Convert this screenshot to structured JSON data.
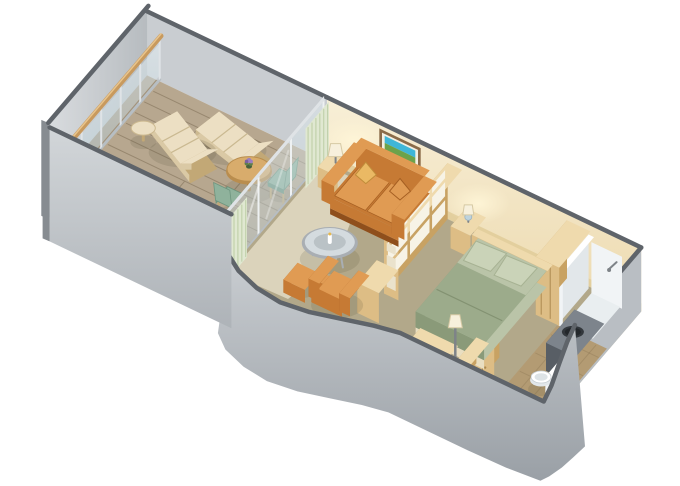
{
  "meta": {
    "title": "Veranda Stateroom Isometric Floor Plan",
    "kind": "isometric-floorplan-illustration"
  },
  "colors": {
    "bg": "#ffffff",
    "wall_edge": "#5f646a",
    "wall_cap_side": "#878c91",
    "wall_gray": "#c9cdd1",
    "wall_gray_right": "#b9bec3",
    "grad_l1": "#d9dcdf",
    "grad_l2": "#b6bbbf",
    "grad_f1": "#d2d6d9",
    "grad_f2": "#aeb3b8",
    "grad_c1": "#c9cdd1",
    "grad_c2": "#9aa0a6",
    "cream1": "#f8efd7",
    "cream2": "#ecd9ae",
    "cream_base": "#e3cf9e",
    "glow": "#fff6d8",
    "floor": "#b2a88a",
    "rug": "#dbd3bb",
    "deck": "#b7a78f",
    "deck_dark": "#a3937b",
    "deck_line": "#97876f",
    "rail_frame": "#dfe3e6",
    "rail_frame2": "#eef1f2",
    "glass1": "#e3eef2",
    "glass2": "#b7ccd5",
    "handrail": "#c89a5e",
    "handrail_hi": "#e8c48c",
    "curtain": "#e0e8d1",
    "curtain_dk": "#c2d1ac",
    "wood_top": "#efdaad",
    "wood_front": "#ddbd85",
    "wood_side": "#c8a263",
    "wood_seam": "#ad8a50",
    "sofa_light": "#e09b53",
    "sofa_mid": "#c67a34",
    "sofa_mid2": "#a55f22",
    "sofa_dark": "#8f4f1c",
    "pillow_gold": "#eab964",
    "pillow_gold_dk": "#c08c3a",
    "bed_green": "#9cab8b",
    "bed_green_dk": "#8a9a79",
    "bed_sheet": "#bac4a8",
    "bed_seam": "#839272",
    "bed_skirt": "#e9dec1",
    "bed_skirt_dk": "#d6c7a2",
    "pillow": "#cad3b8",
    "pillow_edge": "#a7b293",
    "lamp_shade": "#f7f0dc",
    "lamp_shade_edge": "#d6c9a4",
    "lamp_blue": "#bed3dd",
    "metal": "#7e8388",
    "chair_green": "#8fb29c",
    "chair_green_dk": "#6d957e",
    "lounge_light": "#ecdfc3",
    "lounge_shade": "#dac9a5",
    "lounge_shade2": "#ccb990",
    "lounge_frame": "#c2a876",
    "lounge_seam": "#cab991",
    "table_top": "#d8ac6c",
    "table_side": "#b98d4e",
    "table_leg": "#a87e42",
    "pot": "#46603c",
    "flower1": "#9b7fc0",
    "flower2": "#7b5fa0",
    "leaf": "#5d7f4a",
    "glass_rim": "#a9aeb3",
    "glass_top": "#d6dde1",
    "glass_inner": "#b5bdc2",
    "counter_top": "#7d848c",
    "counter_front": "#585e65",
    "counter_side": "#494e54",
    "sink": "#32373c",
    "sink2": "#23272b",
    "white": "#ffffff",
    "white2": "#f1f4f6",
    "white3": "#e2e7ea",
    "tray": "#e9eef0",
    "bath_floor": "#b39b73",
    "mirror": "#e9f1f5",
    "mirror_frame": "#b7bec3",
    "seat": "#dde3e6",
    "pic_frame": "#8a6b49",
    "pic_mat": "#f3efe2",
    "pic_sky": "#3fb6d8",
    "pic_land": "#6ca24b",
    "pane": "#f7f3e6",
    "pane_dk": "#eae2cc",
    "candle_flame": "#e8b84b",
    "shadow": "rgba(90,78,58,0.16)"
  },
  "scene": {
    "areas": [
      {
        "name": "balcony",
        "items": [
          "glass-railing",
          "wood-handrail",
          "deck-planks",
          "lounge-chair-1",
          "lounge-chair-2",
          "balcony-side-table",
          "dining-table",
          "flower-pot",
          "dining-chair-1",
          "dining-chair-2"
        ]
      },
      {
        "name": "living-room",
        "items": [
          "sliding-glass-door",
          "curtain-back",
          "curtain-front",
          "sofa",
          "throw-pillows",
          "wall-art",
          "table-lamp",
          "side-table",
          "glass-coffee-table",
          "armchair",
          "ottoman",
          "room-divider",
          "divider-cabinet"
        ]
      },
      {
        "name": "bedroom",
        "items": [
          "double-bed",
          "bed-pillows",
          "headboard",
          "nightstand",
          "bedside-lamp",
          "floor-lamp",
          "foot-bench",
          "vanity-desk",
          "wardrobe",
          "closet"
        ]
      },
      {
        "name": "bathroom",
        "items": [
          "shower",
          "shower-head",
          "vanity-sink",
          "mirror",
          "toilet"
        ]
      }
    ]
  }
}
